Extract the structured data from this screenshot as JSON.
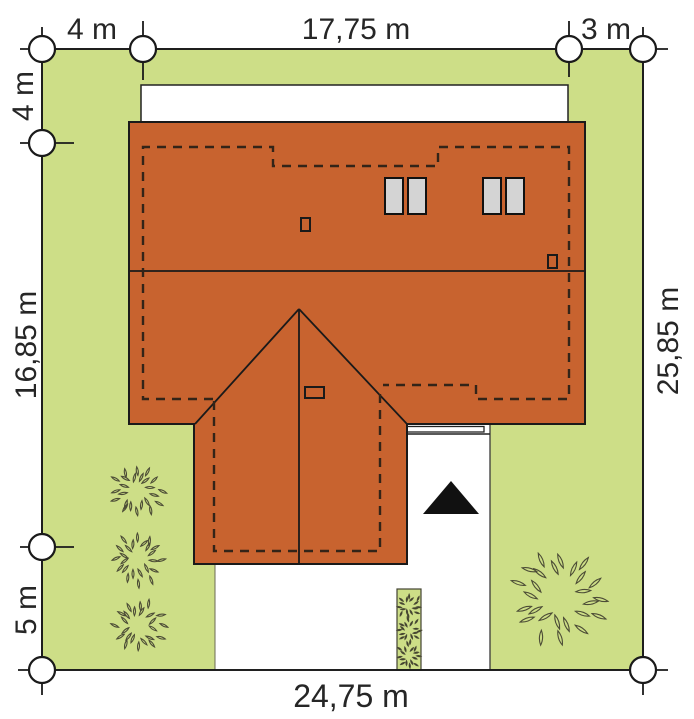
{
  "dims": {
    "top_left_setback": "4 m",
    "top_house_width": "17,75 m",
    "top_right_setback": "3 m",
    "left_top_setback": "4 m",
    "left_house_depth": "16,85 m",
    "left_bottom_setback": "5 m",
    "right_plot_depth": "25,85 m",
    "bottom_plot_width": "24,75 m"
  },
  "colors": {
    "lawn": "#cdde87",
    "roof": "#c8632f",
    "skylight": "#d4d4d4",
    "line": "#1a1a1a",
    "dash": "#332418",
    "arrow": "#111111",
    "foliage": "#4c4c36",
    "foliage_dark": "#3a3a26"
  }
}
